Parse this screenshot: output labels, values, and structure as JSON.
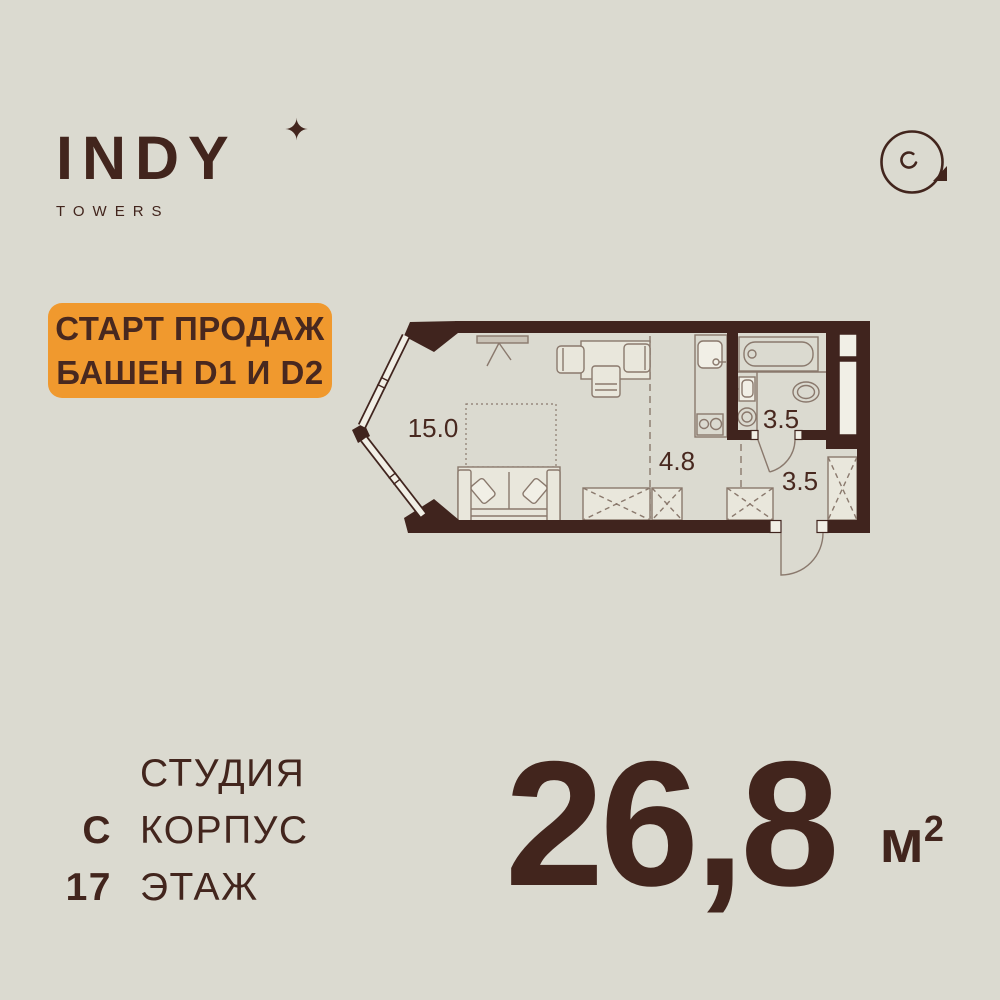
{
  "colors": {
    "background": "#dbdad0",
    "ink": "#42251d",
    "wall": "#40241e",
    "orange": "#f0992e",
    "furniture_line": "#8a796d",
    "furniture_fill": "#e9e7dc"
  },
  "header": {
    "brand": "INDY",
    "brand_sub": "TOWERS",
    "sparkle_icon": "✦",
    "view_icon": "360-rotate-icon"
  },
  "badge": {
    "line1": "СТАРТ ПРОДАЖ",
    "line2": "БАШЕН D1 И D2"
  },
  "floor_plan": {
    "rooms": [
      {
        "name": "living-room",
        "area": "15.0"
      },
      {
        "name": "kitchen-hall",
        "area": "4.8"
      },
      {
        "name": "bathroom",
        "area": "3.5"
      },
      {
        "name": "entry-hall",
        "area": "3.5"
      }
    ]
  },
  "details": {
    "rows": [
      {
        "value": "",
        "label": "СТУДИЯ"
      },
      {
        "value": "С",
        "label": "КОРПУС"
      },
      {
        "value": "17",
        "label": "ЭТАЖ"
      }
    ]
  },
  "area": {
    "value": "26,8",
    "unit": "м",
    "unit_sup": "2"
  }
}
